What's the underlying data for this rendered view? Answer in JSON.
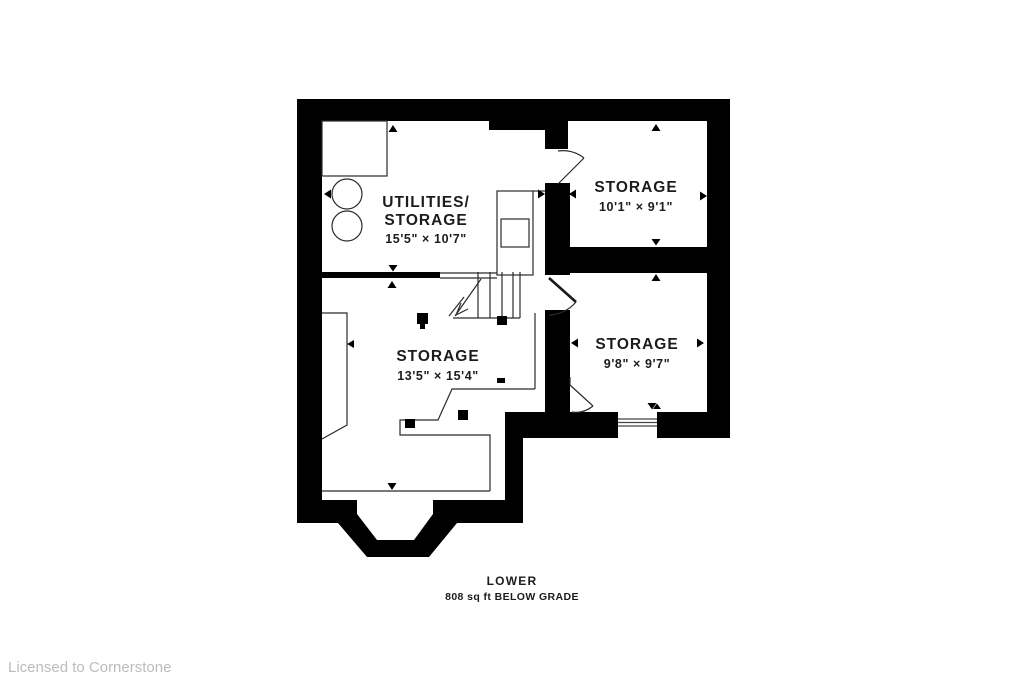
{
  "plan": {
    "type": "floor-plan",
    "level_label": "LOWER",
    "area_label": "808 sq ft BELOW GRADE",
    "rooms": [
      {
        "id": "utilities-storage",
        "line1": "UTILITIES/",
        "line2": "STORAGE",
        "dims": "15'5\" × 10'7\""
      },
      {
        "id": "storage-top-right",
        "line1": "STORAGE",
        "dims": "10'1\" × 9'1\""
      },
      {
        "id": "storage-mid-right",
        "line1": "STORAGE",
        "dims": "9'8\" × 9'7\""
      },
      {
        "id": "storage-main",
        "line1": "STORAGE",
        "dims": "13'5\" × 15'4\""
      }
    ],
    "features": [
      "stairs",
      "door-swings",
      "window",
      "bay-window",
      "laundry-tubs",
      "posts"
    ],
    "colors": {
      "walls": "#000000",
      "label_text": "#1c1c1c",
      "watermark_text": "#bcbcbc",
      "background": "#ffffff"
    }
  },
  "watermark": "Licensed to Cornerstone"
}
